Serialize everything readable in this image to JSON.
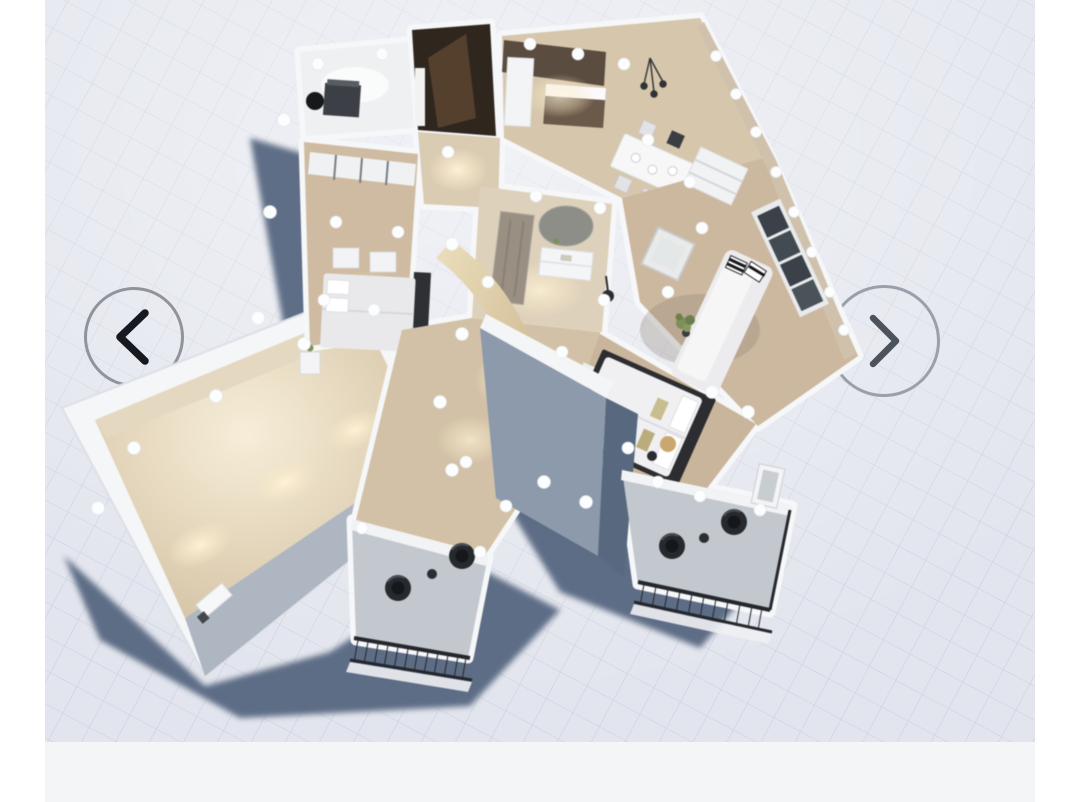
{
  "viewer": {
    "app": "3D floor plan viewer",
    "view": "aerial cutaway dollhouse view of an apartment on a drafting grid",
    "carousel": {
      "prev_label": "Previous floor plan view",
      "next_label": "Next floor plan view"
    }
  },
  "colors": {
    "canvas_grid_bg": "#e2e5ed",
    "grid_line": "#c7ccdb",
    "page_margin": "#ffffff",
    "footer_bar": "#f4f5f7",
    "ground_shadow": "#50607a",
    "wall_top": "#f6f7f9",
    "wood_floor": "#cbb79d",
    "interior_lit_wall": "#d8c9b0",
    "exterior_wall": "#8e9cae",
    "tower_wall_dark": "#58697f",
    "balcony_floor": "#c3c7ce",
    "railing": "#23262b",
    "closet_wood_dark": "#2f261e",
    "kitchen_cabinet": "#5a4c3f",
    "window_frame": "#394047",
    "sofa": "#ececee",
    "plant": "#7c9058",
    "arrow_circle": "#8f939c",
    "arrow_prev_chevron": "#171922",
    "arrow_next_chevron": "#4d535c"
  },
  "scene": {
    "rooms": [
      {
        "name": "office nook",
        "furniture": [
          "dark desk",
          "black swivel chair"
        ]
      },
      {
        "name": "walk-in closet",
        "furniture": [
          "dark brown wardrobe",
          "open wood door"
        ]
      },
      {
        "name": "kitchen",
        "furniture": [
          "dark wood cabinets",
          "white counter",
          "pendant lights"
        ]
      },
      {
        "name": "dining area",
        "furniture": [
          "white dining table",
          "chairs",
          "table settings"
        ]
      },
      {
        "name": "living room",
        "furniture": [
          "white sofa with striped pillows",
          "glass coffee table",
          "tall dark windows",
          "potted plant",
          "floor lamp",
          "white shelf unit"
        ]
      },
      {
        "name": "entry hall bathroom",
        "furniture": [
          "grey door",
          "round mirror",
          "white vanity"
        ]
      },
      {
        "name": "bedroom one",
        "furniture": [
          "double bed with dark side rail",
          "white wardrobes",
          "dressers",
          "nightstand"
        ]
      },
      {
        "name": "master bedroom",
        "furniture": [
          "double bed with dark frame",
          "bench",
          "round side table",
          "floor lamp"
        ]
      },
      {
        "name": "long side room",
        "furniture": [
          "radiator"
        ]
      },
      {
        "name": "balcony one",
        "furniture": [
          "dark mesh railing",
          "two dark egg chairs",
          "small table"
        ]
      },
      {
        "name": "balcony two",
        "furniture": [
          "dark mesh railing",
          "two dark egg chairs",
          "side table",
          "white door"
        ]
      }
    ],
    "lighting": "recessed ceiling spotlights rendered as white dots with warm floor glow"
  }
}
